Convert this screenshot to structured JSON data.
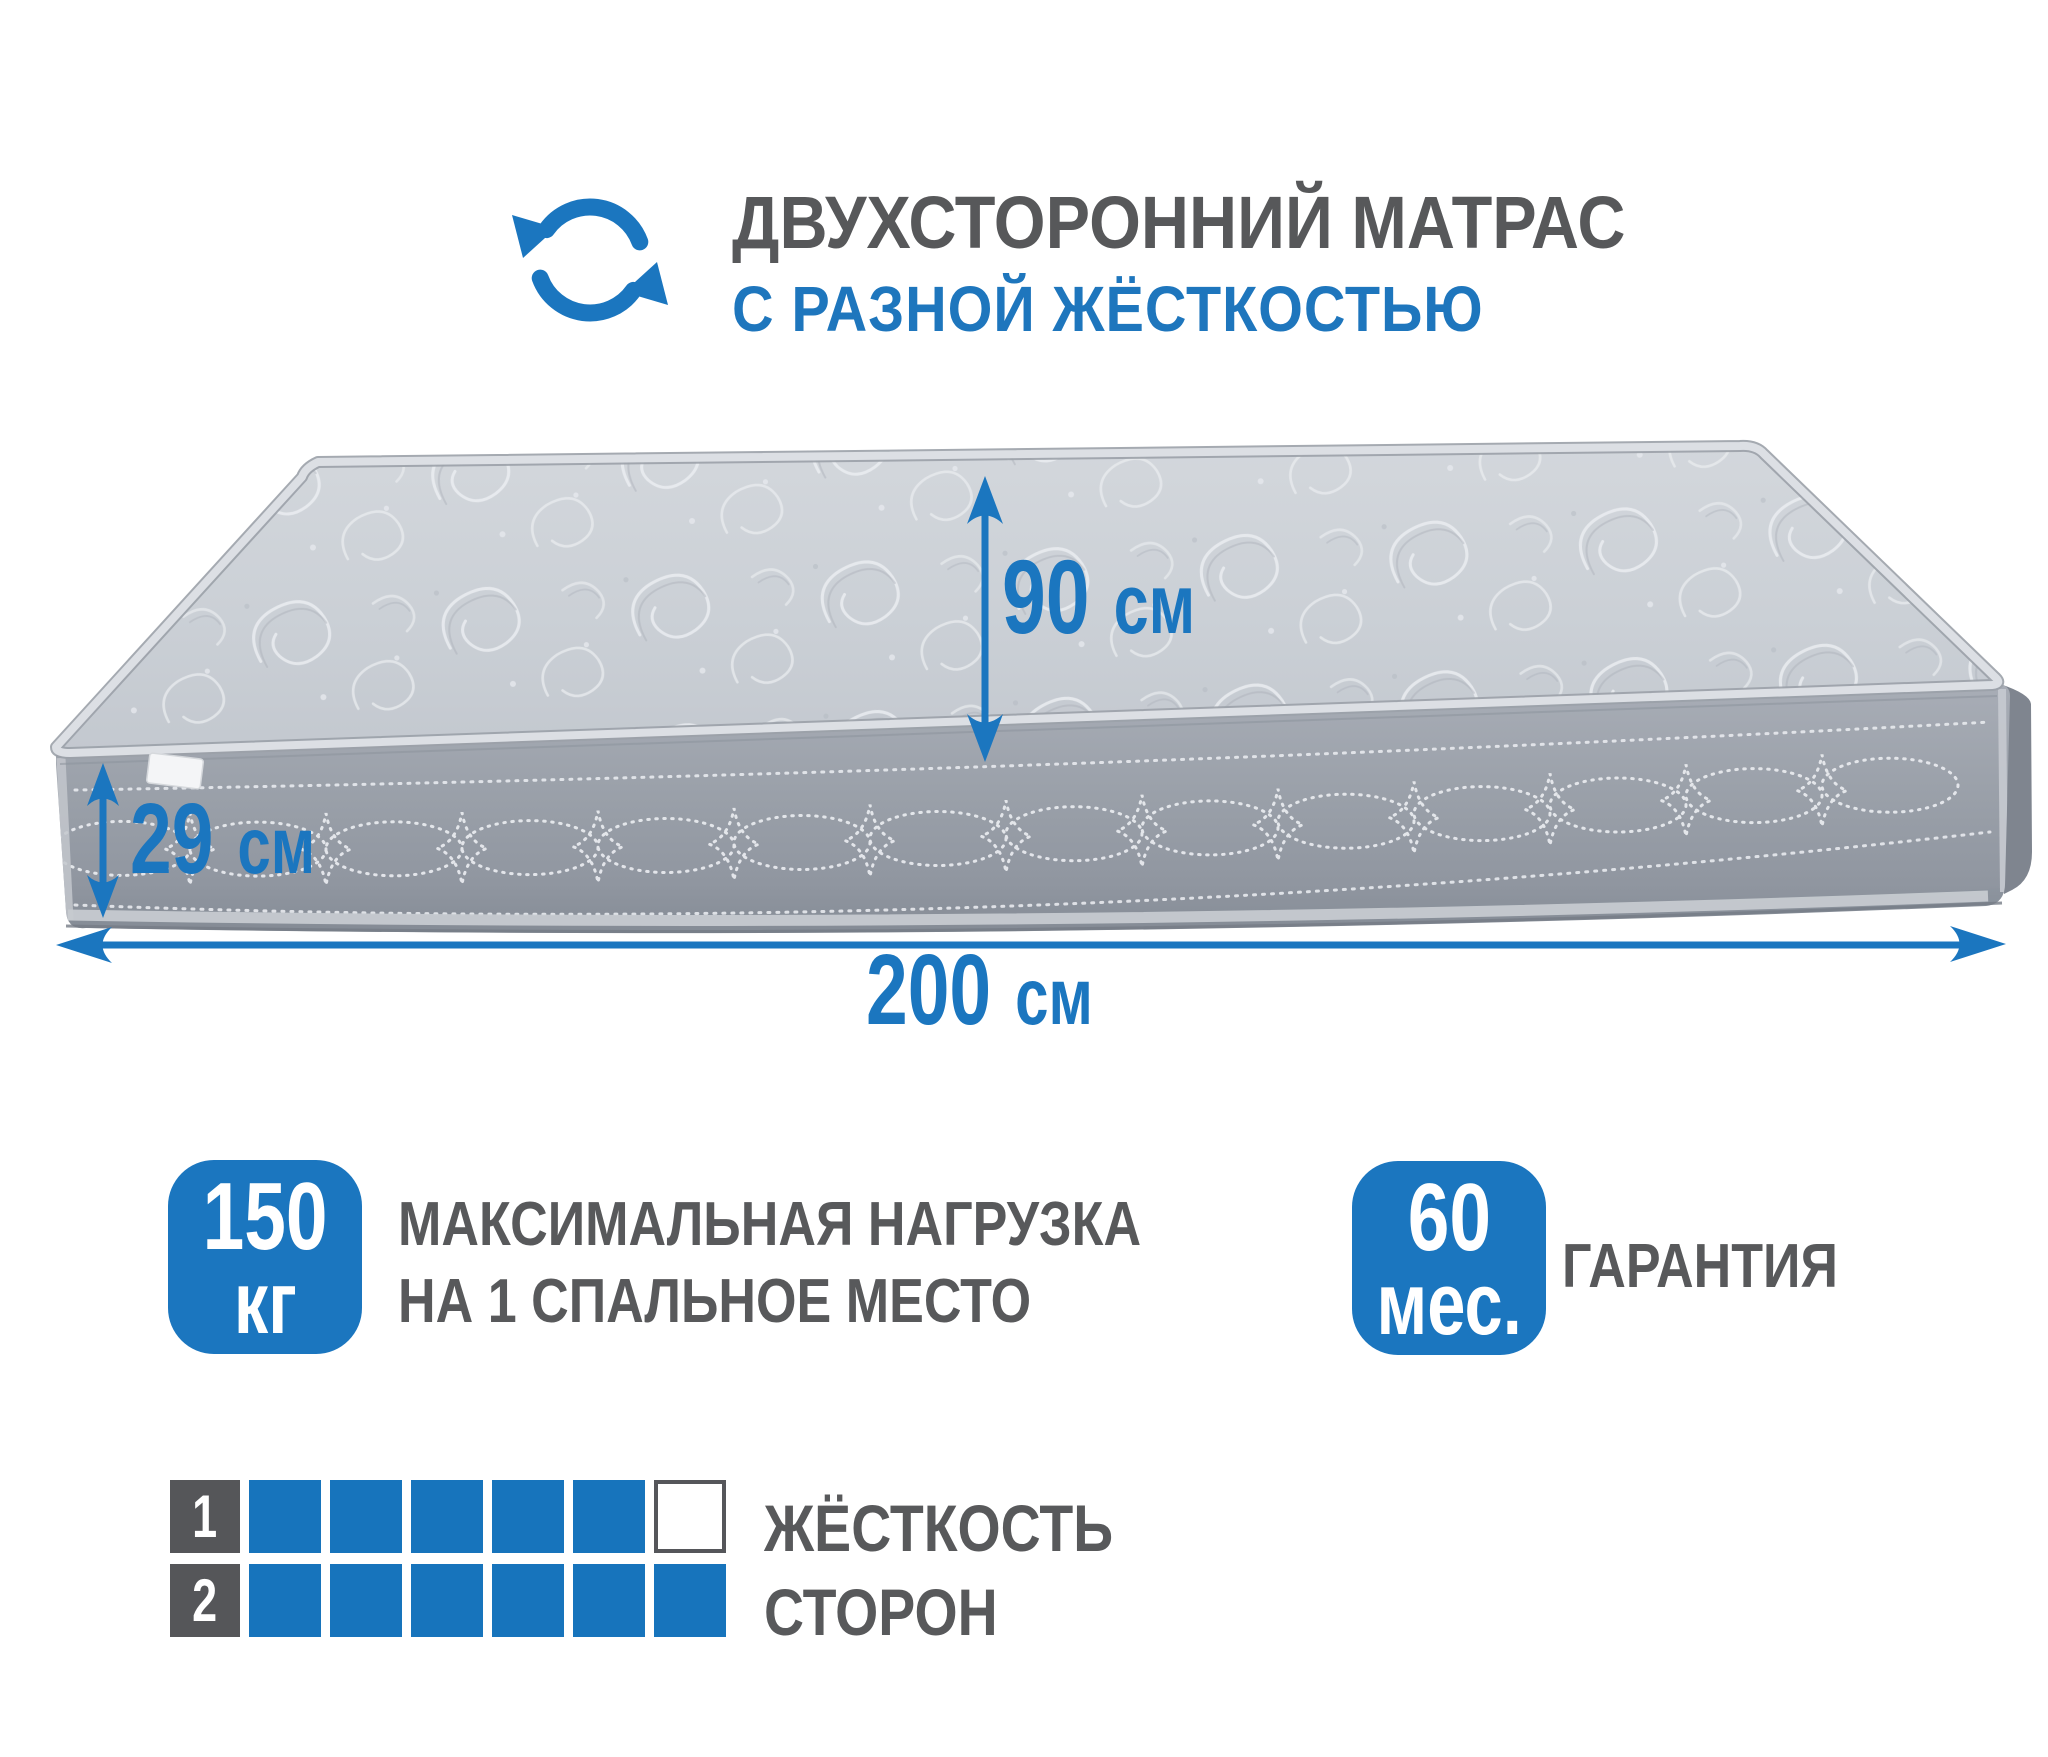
{
  "colors": {
    "accent_blue": "#1b76bf",
    "squares_blue": "#1774bc",
    "label_square_gray": "#555659",
    "text_gray": "#58595b",
    "mattress_top_gray": "#cbd0d6",
    "mattress_front_gray": "#9aa0a9"
  },
  "header": {
    "icon": "rotate-arrows-icon",
    "title": "ДВУХСТОРОННИЙ МАТРАС",
    "subtitle": "С РАЗНОЙ ЖЁСТКОСТЬЮ"
  },
  "dimensions": {
    "width": {
      "value": "90",
      "unit": "см"
    },
    "height": {
      "value": "29",
      "unit": "см"
    },
    "length": {
      "value": "200",
      "unit": "см"
    }
  },
  "features": {
    "max_load": {
      "value": "150",
      "unit": "кг",
      "line1": "МАКСИМАЛЬНАЯ НАГРУЗКА",
      "line2": "НА 1 СПАЛЬНОЕ МЕСТО"
    },
    "warranty": {
      "value": "60",
      "unit": "мес.",
      "label": "ГАРАНТИЯ"
    }
  },
  "hardness": {
    "line1": "ЖЁСТКОСТЬ",
    "line2": "СТОРОН",
    "scale_max": 6,
    "sides": [
      {
        "number": "1",
        "filled": 5
      },
      {
        "number": "2",
        "filled": 6
      }
    ]
  }
}
